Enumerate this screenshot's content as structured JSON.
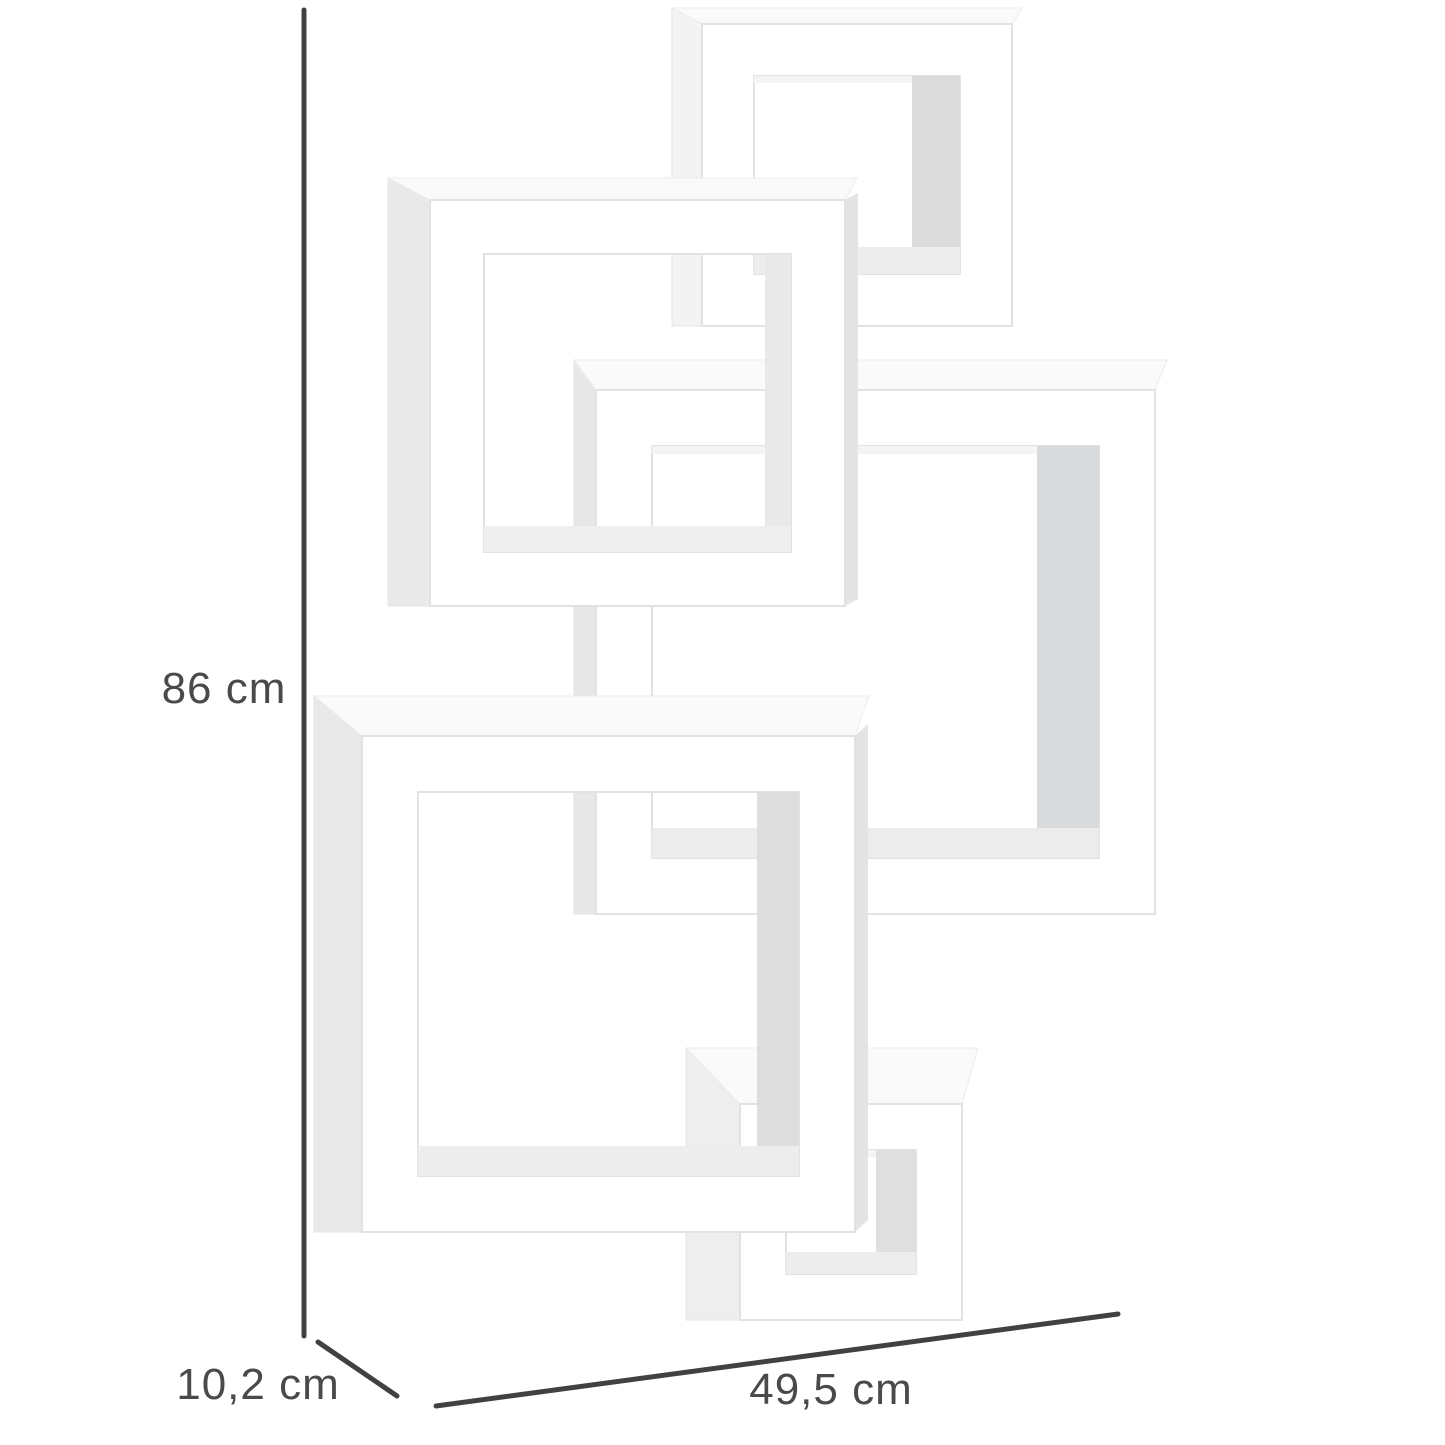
{
  "product": {
    "name": "Interlocking cube wall shelf",
    "color_name": "white",
    "cube_count": 5
  },
  "dimensions": {
    "height": {
      "value": "86",
      "unit": "cm",
      "label": "86 cm"
    },
    "depth": {
      "value": "10,2",
      "unit": "cm",
      "label": "10,2 cm"
    },
    "width": {
      "value": "49,5",
      "unit": "cm",
      "label": "49,5 cm"
    }
  },
  "style": {
    "background_color": "#ffffff",
    "dimension_line_color": "#414141",
    "dimension_text_color": "#4a4a4a",
    "frame_face_color": "#ffffff",
    "frame_edge_color": "#e2e2e2",
    "frame_side_shade_color": "#e9e9e9",
    "frame_inner_shade_color": "#d9dadb"
  }
}
